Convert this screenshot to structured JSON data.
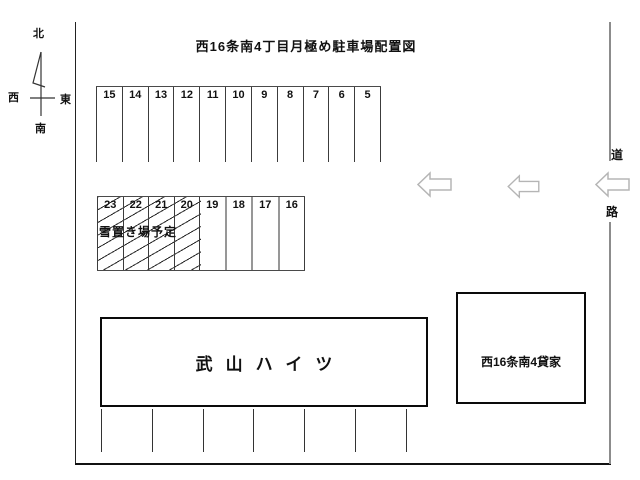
{
  "title": "西16条南4丁目月極め駐車場配置図",
  "compass": {
    "north": "北",
    "west": "西",
    "east": "東",
    "south": "南"
  },
  "parking": {
    "top_row": [
      "15",
      "14",
      "13",
      "12",
      "11",
      "10",
      "9",
      "8",
      "7",
      "6",
      "5"
    ],
    "middle_row": [
      "23",
      "22",
      "21",
      "20",
      "19",
      "18",
      "17",
      "16"
    ],
    "snow_area_label": "雪置き場予定"
  },
  "buildings": {
    "apartment": "武山ハイツ",
    "rental_house": "西16条南4貸家"
  },
  "road": {
    "char_top": "道",
    "char_bottom": "路"
  },
  "colors": {
    "line": "#3c3c3c",
    "building_border": "#0a0a0a",
    "arrow_outline": "#b5b5b5",
    "road_boundary": "#8c8c8c"
  }
}
